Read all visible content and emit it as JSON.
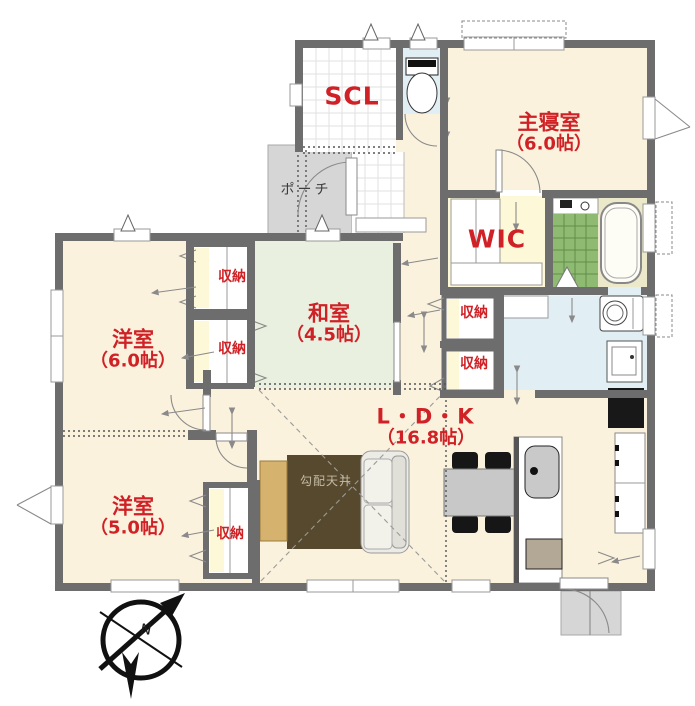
{
  "rooms": {
    "master_bedroom": {
      "name": "主寝室",
      "size": "（6.0帖）"
    },
    "japanese_room": {
      "name": "和室",
      "size": "（4.5帖）"
    },
    "western_room_1": {
      "name": "洋室",
      "size": "（6.0帖）"
    },
    "western_room_2": {
      "name": "洋室",
      "size": "（5.0帖）"
    },
    "ldk": {
      "name": "L・D・K",
      "size": "（16.8帖）"
    },
    "shoe_closet": {
      "name": "SCL"
    },
    "walk_in_closet": {
      "name": "WIC"
    },
    "porch": {
      "name": "ポーチ"
    }
  },
  "storages": [
    "収納",
    "収納",
    "収納",
    "収納",
    "収納"
  ],
  "annotations": {
    "sloped_ceiling": "勾配天井",
    "compass_north": "N"
  },
  "colors": {
    "wall": "#6d6d6d",
    "label_red": "#cf2126",
    "floor_cream": "#fbf2de",
    "tatami_green": "#e9f0df",
    "water_blue": "#e1eef4",
    "porch_gray": "#d6d6d6",
    "storage_yellow": "#fdf8d7",
    "bath_tile": "#8fba72",
    "bath_floor": "#ece9cb",
    "rug_brown": "#57492e",
    "tv_board": "#d6b26f",
    "sofa_gray": "#ecebe5",
    "table_gray": "#c8c8c8",
    "chair_black": "#161616",
    "grid_gray": "#e2e2e2"
  }
}
